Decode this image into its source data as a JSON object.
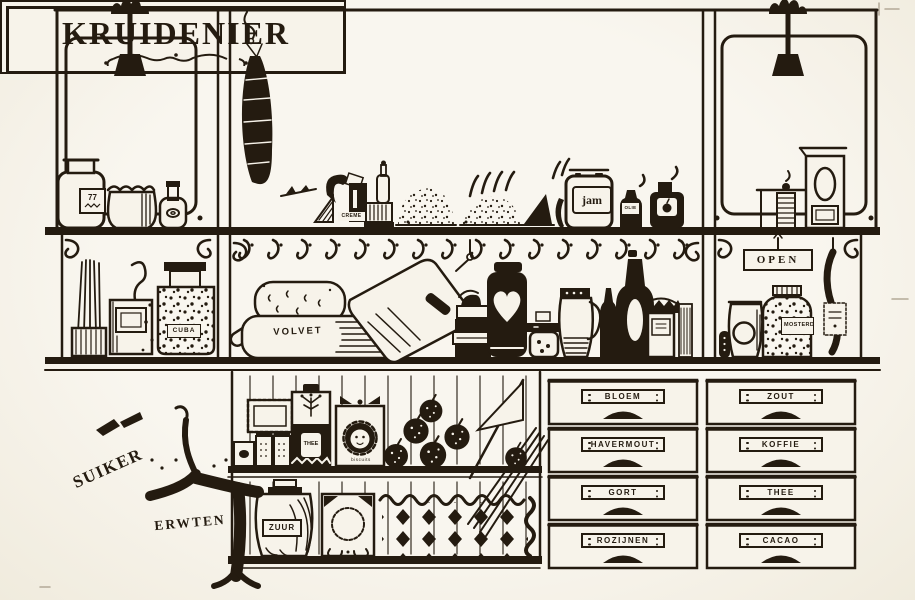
{
  "illustration": {
    "paper_color": "#f7f3ea",
    "ink_color": "#241b10",
    "sign": {
      "title": "KRUIDENIER"
    },
    "open_sign": "OPEN",
    "top_shelf": {
      "jar_label": "77",
      "creme": "CREME",
      "jam": "jam",
      "olie": "OLIE"
    },
    "middle_shelf": {
      "cuba": "CUBA",
      "volvet": "VOLVET",
      "mosterd": "MOSTERD"
    },
    "bottom": {
      "suiker": "SUIKER",
      "erwten": "ERWTEN",
      "thee_canister": "THEE",
      "biscuits": "biscuits",
      "zuur": "ZUUR"
    },
    "drawers": [
      {
        "label": "BLOEM"
      },
      {
        "label": "ZOUT"
      },
      {
        "label": "HAVERMOUT"
      },
      {
        "label": "KOFFIE"
      },
      {
        "label": "GORT"
      },
      {
        "label": "THEE"
      },
      {
        "label": "ROZIJNEN"
      },
      {
        "label": "CACAO"
      }
    ]
  }
}
